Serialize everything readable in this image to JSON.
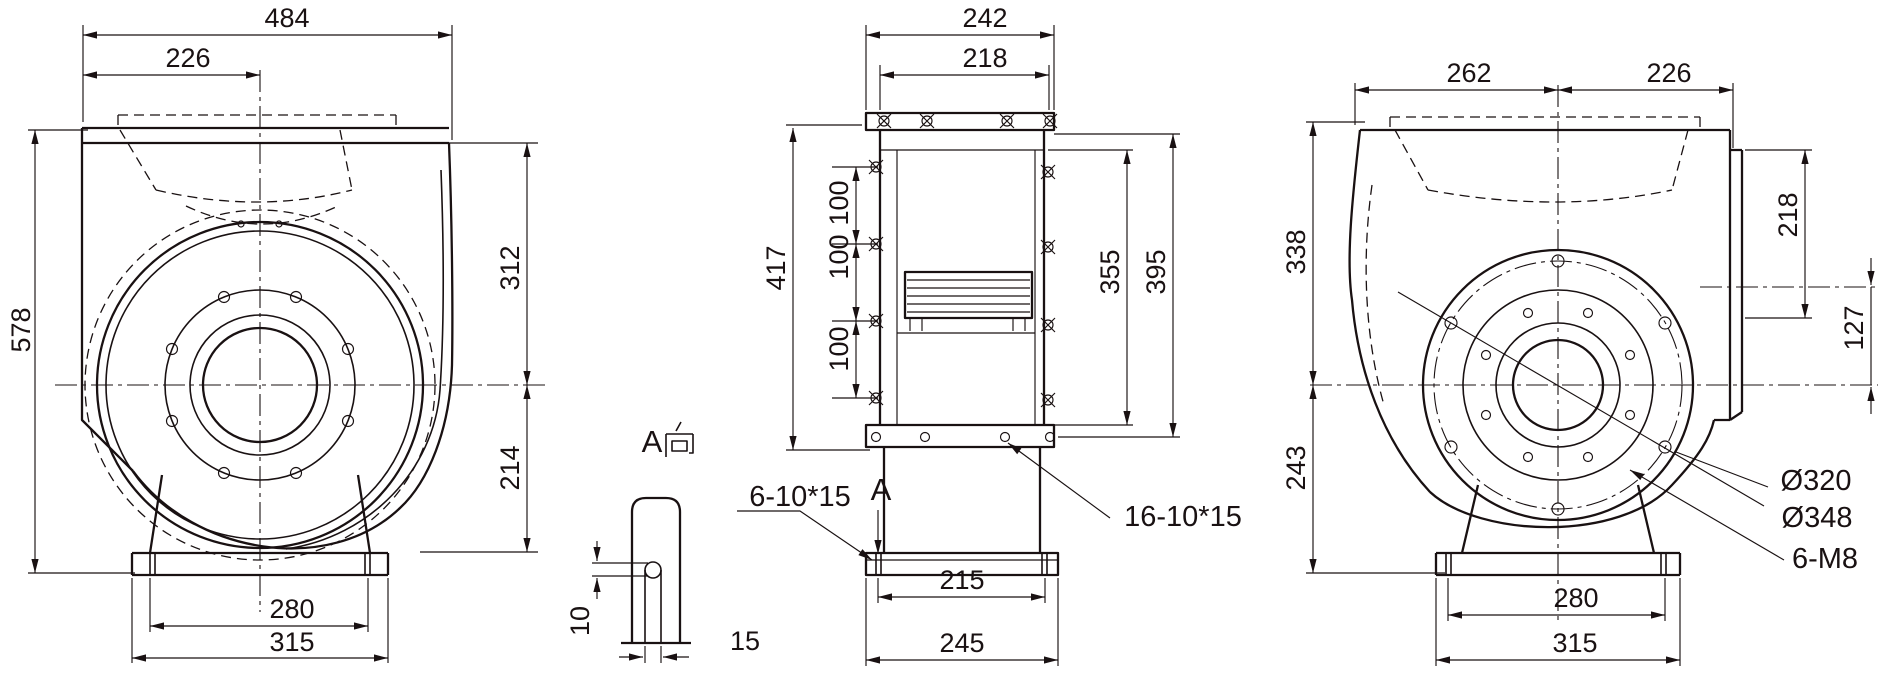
{
  "meta": {
    "type": "technical-drawing",
    "subject": "centrifugal fan dimensional drawing, three orthographic views"
  },
  "colors": {
    "background": "#ffffff",
    "ink": "#191112"
  },
  "views": {
    "front": {
      "name": "front-view",
      "dims": {
        "overall_width": "484",
        "inlet_center_offset": "226",
        "overall_height": "578",
        "center_to_top": "312",
        "center_to_base": "214",
        "base_bolt_spacing": "280",
        "base_width": "315"
      }
    },
    "side": {
      "name": "side-view",
      "dims": {
        "overall_depth": "242",
        "casing_depth": "218",
        "flange_height": "417",
        "bolt_pitch_top": "100",
        "bolt_pitch_mid": "100",
        "bolt_pitch_bottom": "100",
        "casing_height": "355",
        "bolt_span": "395",
        "foot_slot_spacing": "215",
        "foot_depth": "245"
      },
      "notes": {
        "foot_slots": "6-10*15",
        "view_mark": "A",
        "flange_slots": "16-10*15"
      }
    },
    "detail": {
      "view_label": "A向",
      "view_label_a": "A",
      "dims": {
        "slot_width": "10",
        "slot_length": "15"
      }
    },
    "rear": {
      "name": "rear-view",
      "dims": {
        "center_to_left": "262",
        "center_to_right": "226",
        "center_to_top": "338",
        "center_to_base": "243",
        "outlet_height": "218",
        "outlet_center_offset": "127",
        "bolt_circle_diameter": "Ø320",
        "flange_diameter": "Ø348",
        "motor_bolt_note": "6-M8",
        "base_bolt_spacing": "280",
        "base_width": "315"
      }
    }
  }
}
